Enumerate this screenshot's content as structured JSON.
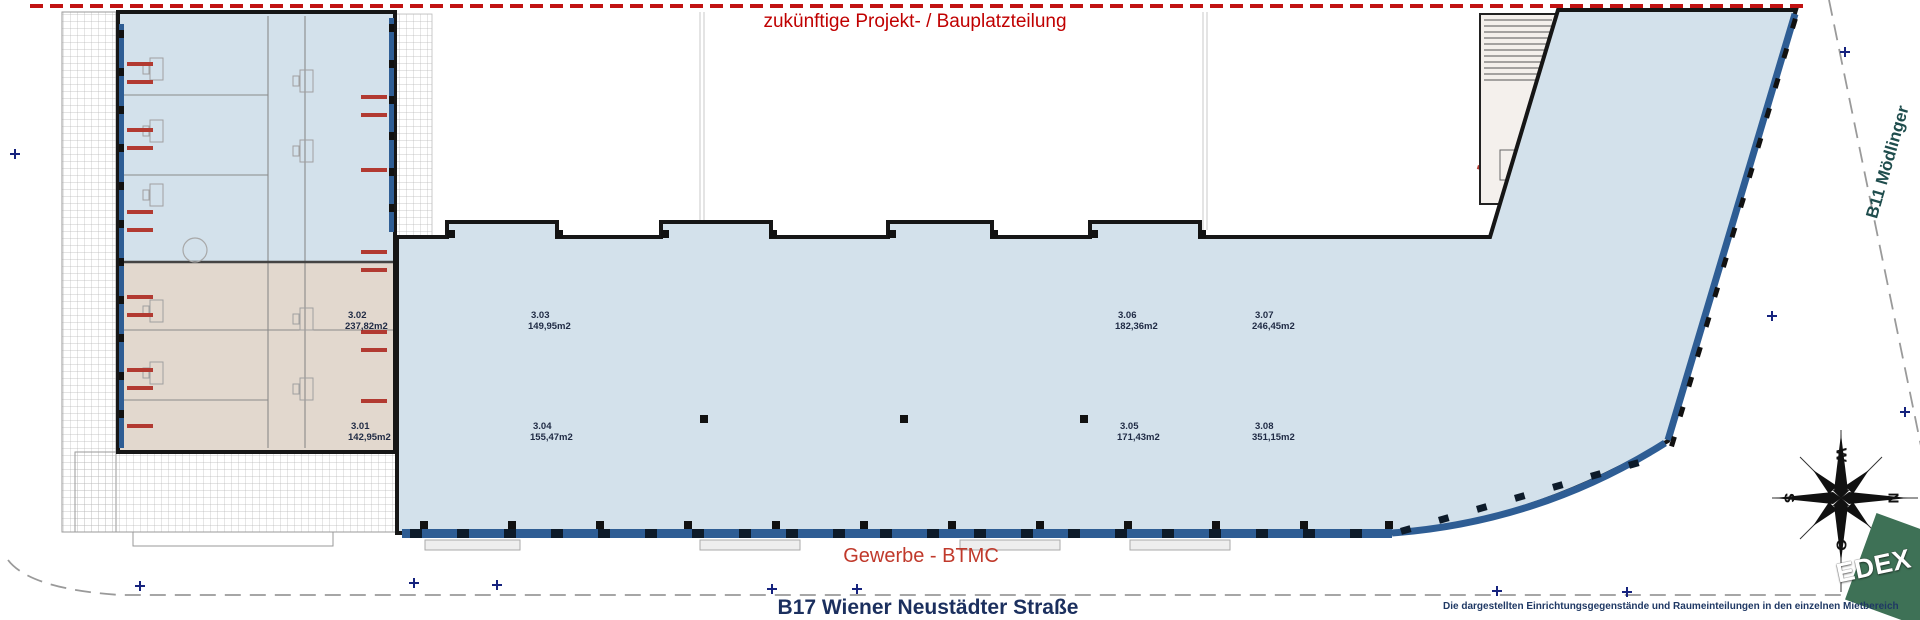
{
  "title": "zukünftige Projekt- / Bauplatzteilung",
  "zones": {
    "gewerbe": "Gewerbe - BTMC"
  },
  "streets": {
    "bottom": "B17 Wiener Neustädter Straße",
    "right": "B11 Mödlinger"
  },
  "disclaimer": "Die dargestellten Einrichtungsgegenstände und Raumeinteilungen in den einzelnen Mietbereich",
  "rooms": [
    {
      "id": "3.01",
      "area": "142,95m2",
      "x": 348,
      "y": 421
    },
    {
      "id": "3.02",
      "area": "237,82m2",
      "x": 345,
      "y": 310
    },
    {
      "id": "3.03",
      "area": "149,95m2",
      "x": 528,
      "y": 310
    },
    {
      "id": "3.04",
      "area": "155,47m2",
      "x": 530,
      "y": 421
    },
    {
      "id": "3.05",
      "area": "171,43m2",
      "x": 1117,
      "y": 421
    },
    {
      "id": "3.06",
      "area": "182,36m2",
      "x": 1115,
      "y": 310
    },
    {
      "id": "3.07",
      "area": "246,45m2",
      "x": 1252,
      "y": 310
    },
    {
      "id": "3.08",
      "area": "351,15m2",
      "x": 1252,
      "y": 421
    }
  ],
  "compass": {
    "top": "W",
    "right": "N",
    "bottom": "O",
    "left": "S"
  },
  "logo": {
    "text": "EDEX",
    "color": "#3e7156"
  },
  "colors": {
    "red_accent": "#c00000",
    "red_marks": "#b23a31",
    "room_blue": "#d3e1eb",
    "room_beige": "#e2d8ce",
    "window_band": "#2e5d94",
    "navy": "#1b2f5e",
    "wall": "#161616"
  }
}
